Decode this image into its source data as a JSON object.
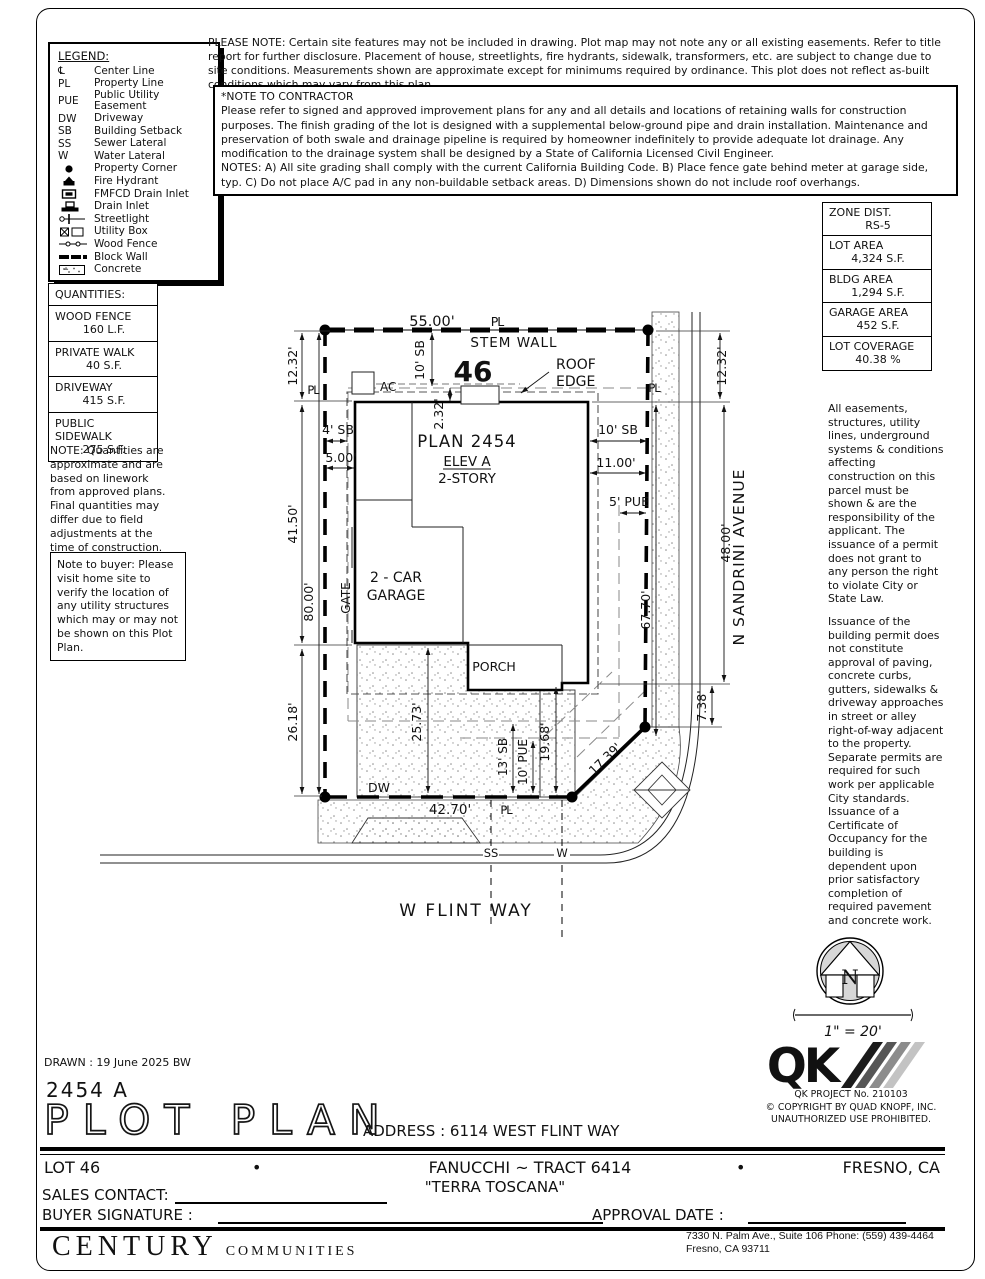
{
  "notes": {
    "please_note": "PLEASE NOTE:  Certain site features may not be included in drawing.  Plot map may not note any or all existing easements. Refer to title report for further disclosure.  Placement of house, streetlights, fire hydrants, sidewalk, transformers, etc. are subject to change due to site conditions.  Measurements shown are approximate except for minimums required by ordinance.  This plot does not reflect as-built conditions which may vary from this plan.",
    "contractor_title": "*NOTE TO CONTRACTOR",
    "contractor_body": "Please refer to signed and approved improvement plans for any and all details and locations of retaining walls for construction purposes. The finish grading of the lot is designed with a supplemental below-ground pipe and drain installation.  Maintenance and preservation of both swale and drainage pipeline is required by homeowner indefinitely to provide adequate lot drainage.  Any modification to the drainage system shall be designed by a State of California Licensed Civil Engineer.",
    "contractor_notes": "NOTES:  A) All site grading shall comply with the current California Building Code.  B) Place fence gate behind meter at garage side, typ.  C) Do not place A/C pad in any non-buildable setback areas.  D) Dimensions shown do not include roof overhangs.",
    "qty_note": "NOTE: Quantities are approximate and are based on linework from approved plans.  Final quantities may differ due to field adjustments at the time of construction.",
    "buyer_note": "Note to buyer: Please visit home site to verify the location of any utility structures which may or may not be shown on this Plot Plan.",
    "easements_p1": "All easements, structures, utility lines, underground systems & conditions affecting construction on this parcel must be shown & are the responsibility of the applicant. The issuance of a permit does not grant to any person the right to violate City or State Law.",
    "easements_p2": "Issuance of the building permit does not constitute approval of paving, concrete curbs, gutters, sidewalks & driveway approaches in street or alley right-of-way adjacent to the property. Separate permits are required for such work per applicable City standards. Issuance of a Certificate of Occupancy for the building is dependent upon prior satisfactory completion of required pavement and concrete work."
  },
  "legend": {
    "title": "LEGEND:",
    "items": [
      {
        "abbr": "℄",
        "label": "Center Line"
      },
      {
        "abbr": "PL",
        "label": "Property Line"
      },
      {
        "abbr": "PUE",
        "label": "Public Utility Easement"
      },
      {
        "abbr": "DW",
        "label": "Driveway"
      },
      {
        "abbr": "SB",
        "label": "Building Setback"
      },
      {
        "abbr": "SS",
        "label": "Sewer Lateral"
      },
      {
        "abbr": "W",
        "label": "Water Lateral"
      },
      {
        "abbr": "",
        "label": "Property Corner"
      },
      {
        "abbr": "",
        "label": "Fire Hydrant"
      },
      {
        "abbr": "",
        "label": "FMFCD Drain Inlet"
      },
      {
        "abbr": "",
        "label": "Drain Inlet"
      },
      {
        "abbr": "",
        "label": "Streetlight"
      },
      {
        "abbr": "",
        "label": "Utility Box"
      },
      {
        "abbr": "",
        "label": "Wood Fence"
      },
      {
        "abbr": "",
        "label": "Block Wall"
      },
      {
        "abbr": "",
        "label": "Concrete"
      }
    ]
  },
  "zone_table": {
    "rows": [
      {
        "label": "ZONE DIST.",
        "value": "RS-5"
      },
      {
        "label": "LOT AREA",
        "value": "4,324 S.F."
      },
      {
        "label": "BLDG AREA",
        "value": "1,294 S.F."
      },
      {
        "label": "GARAGE AREA",
        "value": "452 S.F."
      },
      {
        "label": "LOT COVERAGE",
        "value": "40.38 %"
      }
    ]
  },
  "quantities": {
    "title": "QUANTITIES:",
    "rows": [
      {
        "label": "WOOD FENCE",
        "value": "160 L.F."
      },
      {
        "label": "PRIVATE WALK",
        "value": "40 S.F."
      },
      {
        "label": "DRIVEWAY",
        "value": "415 S.F."
      },
      {
        "label": "PUBLIC SIDEWALK",
        "value": "275 S.F."
      }
    ]
  },
  "plot": {
    "lot_number": "46",
    "plan": "PLAN 2454",
    "elev": "ELEV A",
    "story": "2-STORY",
    "garage_l1": "2 - CAR",
    "garage_l2": "GARAGE",
    "porch": "PORCH",
    "gate": "GATE",
    "stem_wall": "STEM WALL",
    "roof_l1": "ROOF",
    "roof_l2": "EDGE",
    "ac": "AC",
    "dw": "DW",
    "ss": "SS",
    "w": "W",
    "pl": "PL",
    "street_bottom": "W FLINT WAY",
    "street_right": "N SANDRINI AVENUE",
    "dims": {
      "top": "55.00'",
      "left_12": "12.32'",
      "right_12": "12.32'",
      "sb10_top": "10' SB",
      "sb10_right": "10' SB",
      "sb4": "4' SB",
      "d500": "5.00'",
      "d232": "2.32'",
      "d1100": "11.00'",
      "pue5": "5' PUE",
      "d4150": "41.50'",
      "d8000": "80.00'",
      "d2618": "26.18'",
      "d4800": "48.00'",
      "d6770": "67.70'",
      "d738": "7.38'",
      "d2573": "25.73'",
      "sb13": "13' SB",
      "pue10": "10' PUE",
      "d1968": "19.68'",
      "d1739": "17.39'",
      "d4270": "42.70'"
    }
  },
  "north": {
    "letter": "N",
    "scale": "1\" = 20'"
  },
  "qk": {
    "mark": "QK",
    "project": "QK PROJECT No. 210103",
    "copyright": "©  COPYRIGHT BY QUAD KNOPF, INC.",
    "prohibited": "UNAUTHORIZED USE PROHIBITED."
  },
  "titleblock": {
    "drawn": "DRAWN :  19 June 2025  BW",
    "plan_number": "2454  A",
    "title": "PLOT PLAN",
    "address": "ADDRESS :  6114 WEST FLINT WAY"
  },
  "footer": {
    "lot": "LOT 46",
    "bullet": "•",
    "tract": "FANUCCHI ~ TRACT 6414",
    "city": "FRESNO, CA",
    "community": "\"TERRA TOSCANA\"",
    "sales_label": "SALES CONTACT:",
    "buyer_label": "BUYER SIGNATURE :",
    "approval_label": "APPROVAL DATE :",
    "brand_1": "CENTURY",
    "brand_2": "COMMUNITIES",
    "brand_addr_1": "7330 N. Palm Ave., Suite 106    Phone:  (559) 439-4464",
    "brand_addr_2": "Fresno, CA  93711"
  }
}
